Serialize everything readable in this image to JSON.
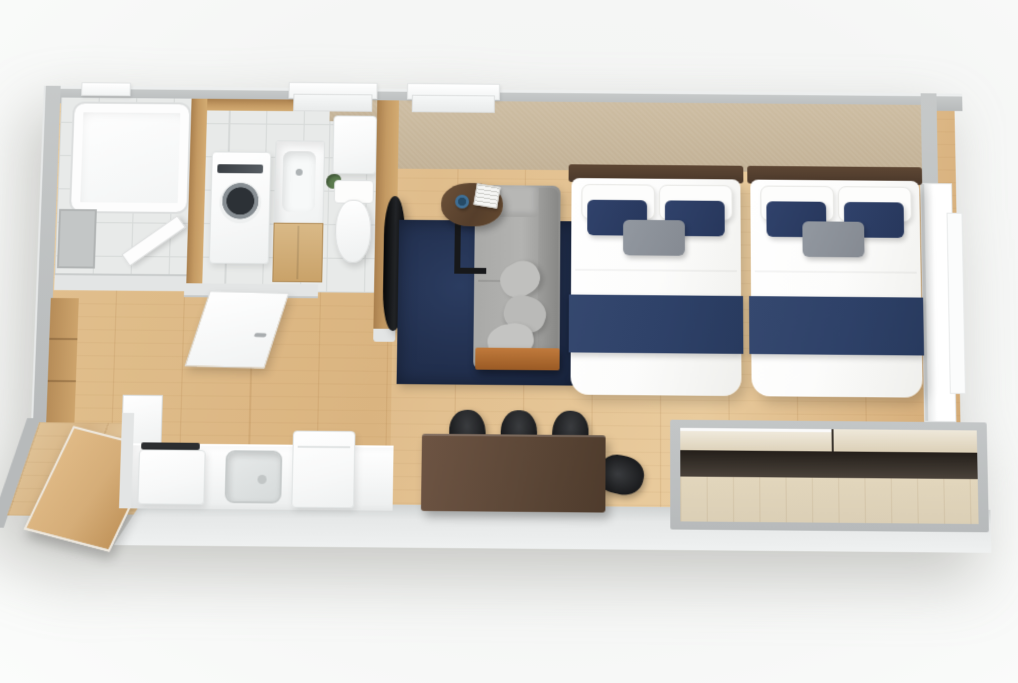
{
  "scene": {
    "type": "3d-isometric-floor-plan",
    "description": "Top-down 3D architectural render of a studio apartment with twin beds, no visible text labels",
    "rooms": [
      {
        "id": "bathroom",
        "label": "Bathroom",
        "items": [
          "bathtub",
          "wall-panel-mirror",
          "swing-door"
        ]
      },
      {
        "id": "laundry",
        "label": "Washroom",
        "items": [
          "washing-machine",
          "vanity-sink-cabinet"
        ]
      },
      {
        "id": "toilet-room",
        "label": "Toilet Room",
        "items": [
          "toilet",
          "cistern-cabinet",
          "plant"
        ]
      },
      {
        "id": "living-room",
        "label": "Living Room",
        "items": [
          "navy-rug",
          "gray-sofa",
          "side-table",
          "wall-tv",
          "coffee-cup",
          "book-cube"
        ]
      },
      {
        "id": "bedroom",
        "label": "Bedroom",
        "items": [
          "twin-bed-left",
          "twin-bed-right",
          "balcony-window"
        ]
      },
      {
        "id": "hallway",
        "label": "Hallway",
        "items": [
          "wood-wall-closet",
          "white-interior-door",
          "entrance-door-open"
        ]
      },
      {
        "id": "kitchen",
        "label": "Kitchen",
        "items": [
          "counter",
          "cooktop",
          "sink",
          "refrigerator"
        ]
      },
      {
        "id": "dining",
        "label": "Dining Area",
        "items": [
          "walnut-table",
          "black-chair",
          "black-chair",
          "black-chair",
          "black-chair"
        ]
      },
      {
        "id": "closet",
        "label": "Closet",
        "items": [
          "sliding-wood-doors"
        ]
      }
    ],
    "bed_styling": {
      "pillows_white": 2,
      "pillows_navy": 2,
      "pillow_gray": 1,
      "throw_band": "navy over white duvet"
    }
  },
  "colors": {
    "background": "#f4f5f4",
    "wall_gray": "#b7babb",
    "wall_light": "#e3e5e5",
    "wall_beige": "#c2b196",
    "wood_floor": "#e0bd8c",
    "wood_floor_light": "#e9cb9d",
    "wood_floor_dark": "#d2a873",
    "wood_wall": "#c49a63",
    "tile": "#e8eae9",
    "tile_line": "#d6d9d8",
    "rug_navy": "#22304f",
    "sofa_gray": "#a9a9a7",
    "sofa_shadow": "#8e8e8c",
    "bed_navy": "#2e4168",
    "pillow_navy": "#27375c",
    "pillow_gray": "#858a92",
    "linen_white": "#fcfcfb",
    "headboard_wood": "#4a382b",
    "table_walnut": "#5c4737",
    "chair_black": "#1b1c1e",
    "appliance_white": "#f7f8f8",
    "closet_wood": "#dbcfb6",
    "door_wood": "#d5ad78",
    "plant_green": "#5a7a4d",
    "cup_blue": "#3e6f96"
  }
}
